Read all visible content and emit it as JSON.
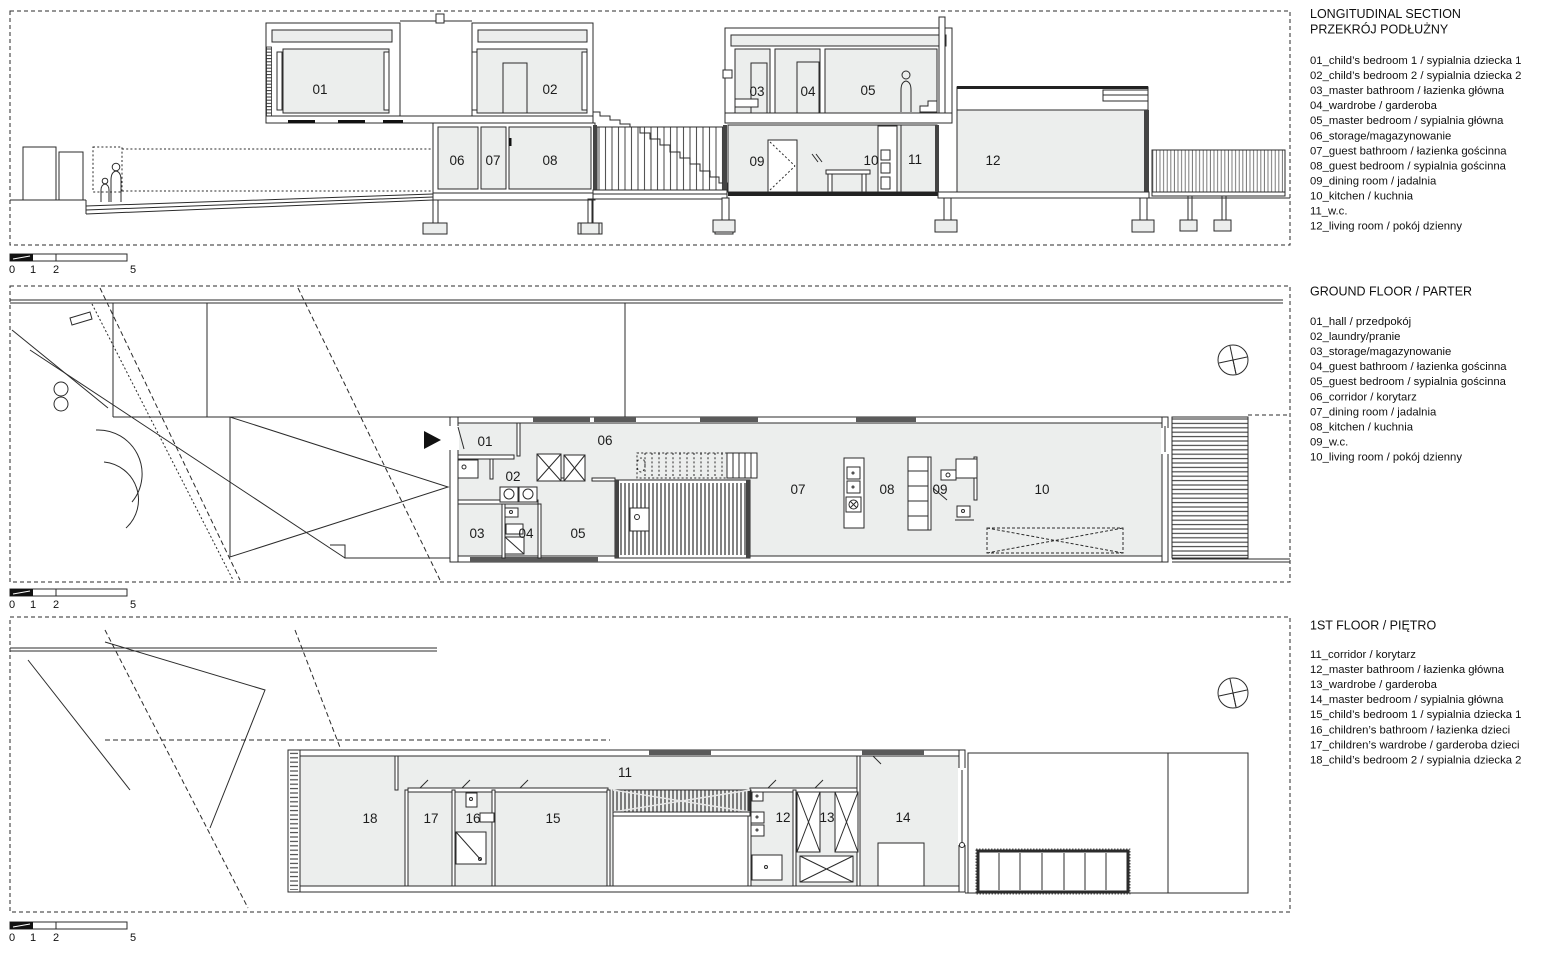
{
  "panels": {
    "section": {
      "title_en": "LONGITUDINAL SECTION",
      "title_pl": "PRZEKRÓJ PODŁUŻNY",
      "items": [
        "01_child’s bedroom 1 / sypialnia dziecka 1",
        "02_child’s bedroom 2 / sypialnia dziecka 2",
        "03_master bathroom / łazienka główna",
        "04_wardrobe / garderoba",
        "05_master bedroom / sypialnia główna",
        "06_storage/magazynowanie",
        "07_guest bathroom / łazienka gościnna",
        "08_guest bedroom / sypialnia gościnna",
        "09_dining room / jadalnia",
        "10_kitchen / kuchnia",
        "11_w.c.",
        "12_living room / pokój dzienny"
      ],
      "rooms": [
        "01",
        "02",
        "03",
        "04",
        "05",
        "06",
        "07",
        "08",
        "09",
        "10",
        "11",
        "12"
      ]
    },
    "ground": {
      "title": "GROUND FLOOR / PARTER",
      "items": [
        "01_hall / przedpokój",
        "02_laundry/pranie",
        "03_storage/magazynowanie",
        "04_guest bathroom / łazienka gościnna",
        "05_guest bedroom / sypialnia gościnna",
        "06_corridor / korytarz",
        "07_dining room / jadalnia",
        "08_kitchen / kuchnia",
        "09_w.c.",
        "10_living room / pokój dzienny"
      ],
      "rooms": [
        "01",
        "02",
        "03",
        "04",
        "05",
        "06",
        "07",
        "08",
        "09",
        "10"
      ]
    },
    "first": {
      "title": "1ST FLOOR / PIĘTRO",
      "items": [
        "11_corridor / korytarz",
        "12_master bathroom / łazienka główna",
        "13_wardrobe / garderoba",
        "14_master bedroom / sypialnia główna",
        "15_child’s bedroom 1 / sypialnia dziecka 1",
        "16_children’s bathroom / łazienka dzieci",
        "17_children’s wardrobe / garderoba dzieci",
        "18_child’s bedroom 2 / sypialnia dziecka 2"
      ],
      "rooms": [
        "11",
        "12",
        "13",
        "14",
        "15",
        "16",
        "17",
        "18"
      ]
    }
  },
  "scale_bar": {
    "labels": [
      "0",
      "1",
      "2",
      "5"
    ]
  },
  "colors": {
    "line": "#2b2b2b",
    "room_fill": "#eceeed",
    "window": "#5a5a5a"
  }
}
